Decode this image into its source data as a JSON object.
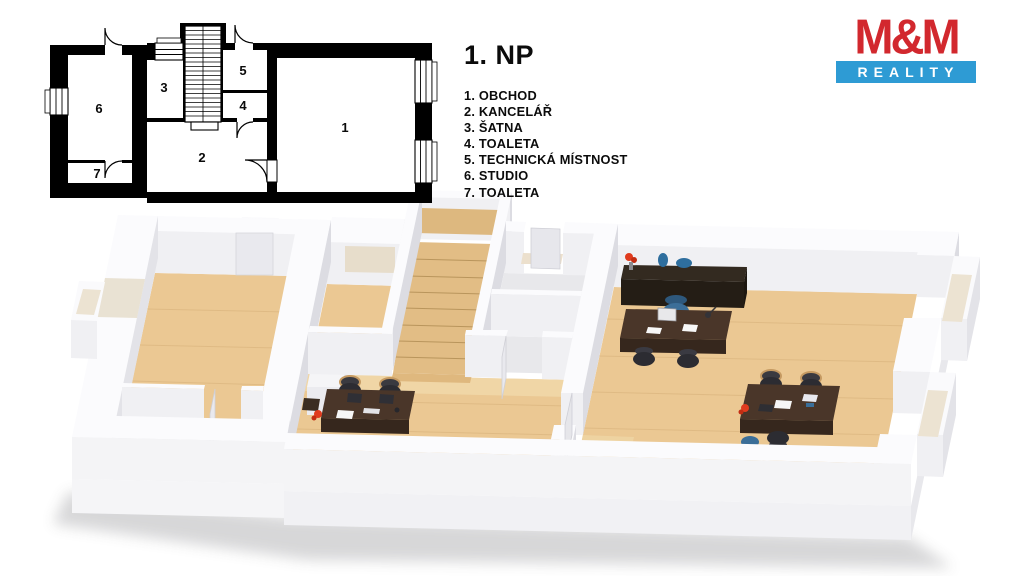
{
  "title": "1. NP",
  "legend": {
    "items": [
      "1. OBCHOD",
      "2. KANCELÁŘ",
      "3. ŠATNA",
      "4. TOALETA",
      "5. TECHNICKÁ MÍSTNOST",
      "6. STUDIO",
      "7. TOALETA"
    ]
  },
  "logo": {
    "top": "M&M",
    "bottom": "REALITY",
    "red": "#d2282e",
    "blue": "#2e9bd4"
  },
  "plan2d": {
    "room_labels": [
      "1",
      "2",
      "3",
      "4",
      "5",
      "6",
      "7"
    ]
  },
  "scene3d": {
    "floor_wood_color": "#ebc893",
    "floor_tile_color": "#e8e8eb",
    "wall_color": "#fbfbfd",
    "desk_color": "#4a3629",
    "cabinet_color": "#332a20",
    "chair_color": "#2c2c32",
    "accent_chair_blue": "#3b6e98",
    "flower_red": "#e03b1e"
  }
}
